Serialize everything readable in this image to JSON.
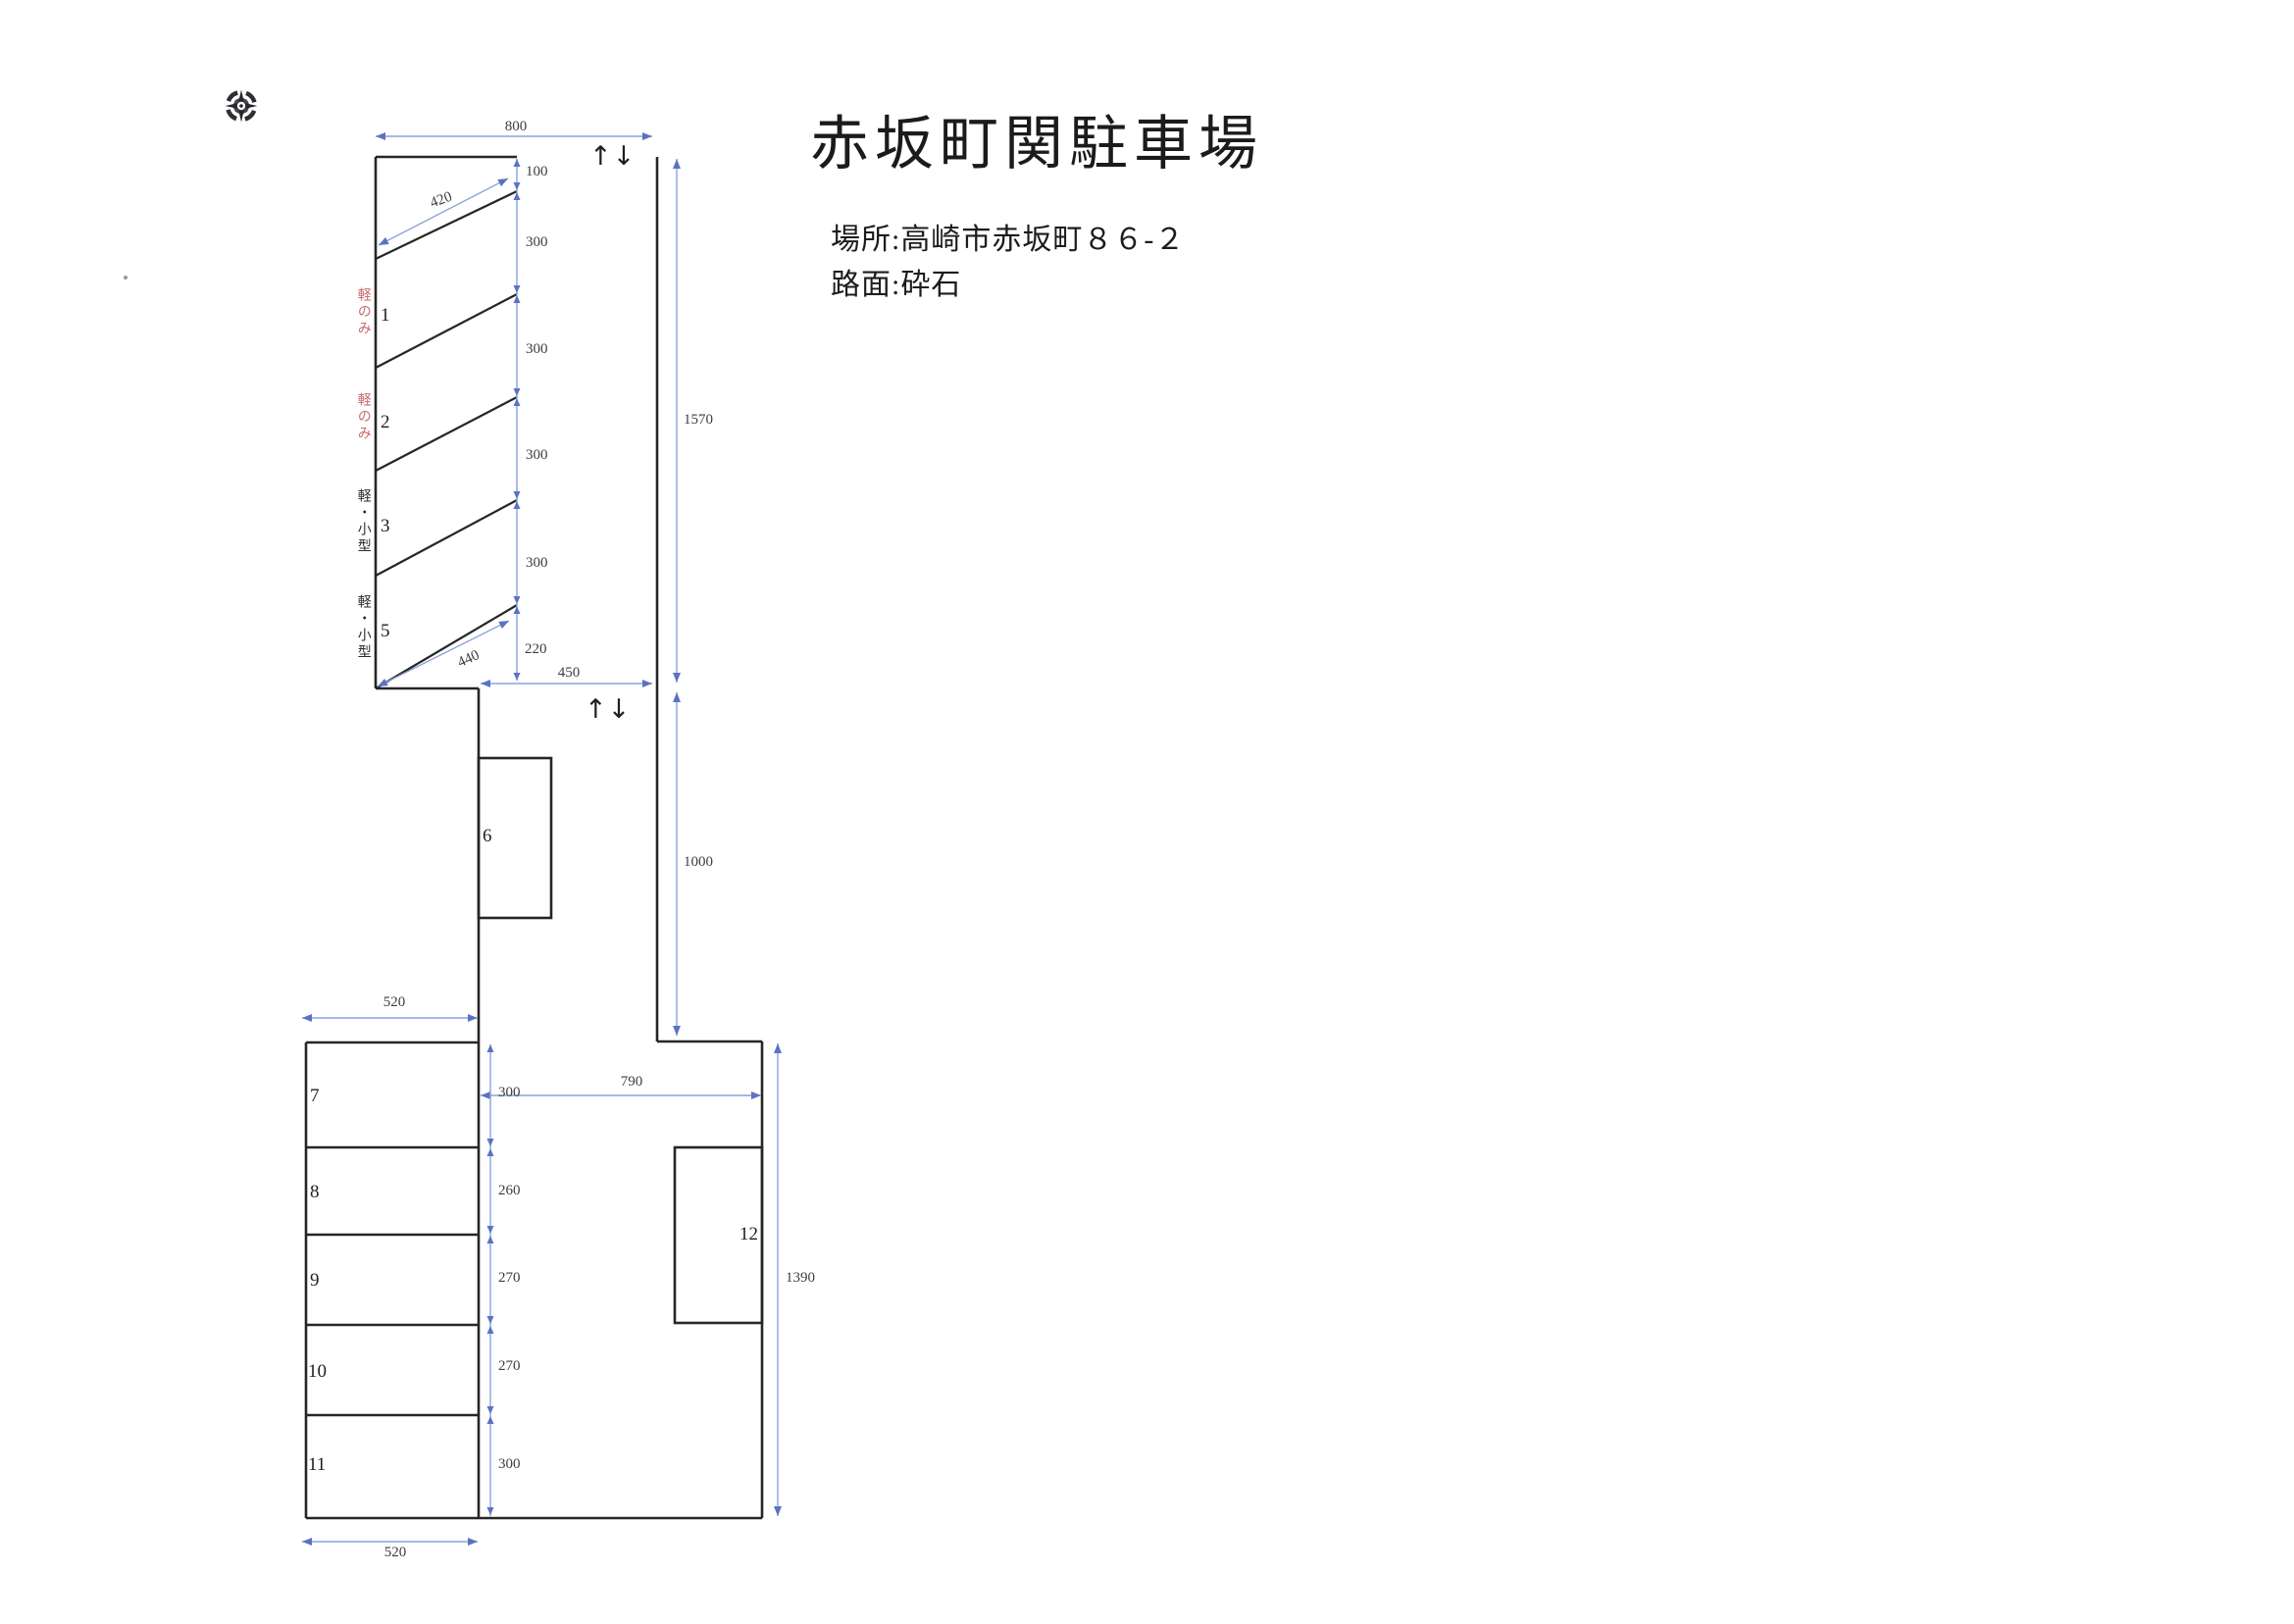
{
  "header": {
    "title": "赤坂町関駐車場",
    "location": "場所:高崎市赤坂町８６-２",
    "surface": "路面:砕石"
  },
  "colors": {
    "wall_line": "#262626",
    "dimension_line": "#8ba3d8",
    "dimension_arrow": "#5b72c4",
    "kei_only_red": "#c96a6a"
  },
  "diagram": {
    "arrow_top": "↑↓",
    "arrow_mid": "↑↓",
    "upper": {
      "dim_top": "800",
      "dim_stall": "420",
      "chain": [
        "100",
        "300",
        "300",
        "300",
        "300",
        "220"
      ],
      "dim_diag": "440",
      "dim_bottom": "450",
      "dim_height": "1570",
      "stalls": [
        {
          "no": "1",
          "tag": "軽のみ"
        },
        {
          "no": "2",
          "tag": "軽のみ"
        },
        {
          "no": "3",
          "tag": "軽・小型"
        },
        {
          "no": "5",
          "tag": "軽・小型"
        }
      ]
    },
    "middle": {
      "stall": "6",
      "dim_height": "1000"
    },
    "lower": {
      "dim_width_top": "520",
      "dim_width_bottom": "520",
      "chain": [
        "300",
        "260",
        "270",
        "270",
        "300"
      ],
      "stalls": [
        "7",
        "8",
        "9",
        "10",
        "11"
      ],
      "dim_aisle": "790",
      "dim_height": "1390",
      "stall_right": "12"
    }
  }
}
